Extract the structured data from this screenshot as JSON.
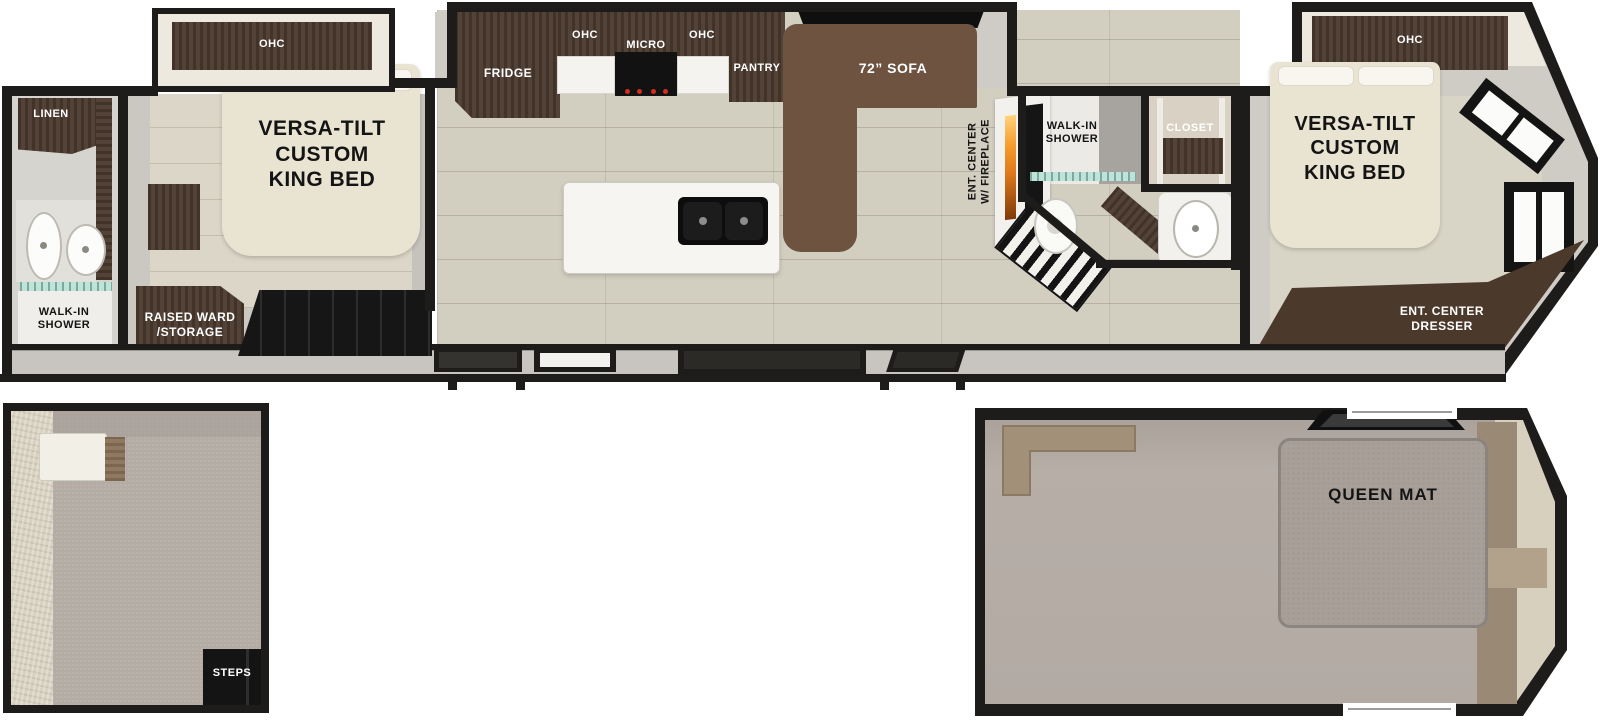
{
  "floorplan": {
    "bath_left": {
      "linen": "LINEN",
      "shower": "WALK-IN\nSHOWER"
    },
    "bedroom_left": {
      "ohc": "OHC",
      "bed": "VERSA-TILT\nCUSTOM\nKING BED",
      "storage": "RAISED WARD\n/STORAGE"
    },
    "kitchen": {
      "fridge": "FRIDGE",
      "ohc_left": "OHC",
      "micro": "MICRO",
      "ohc_right": "OHC",
      "pantry": "PANTRY"
    },
    "living": {
      "sofa": "72” SOFA",
      "ent_center": "ENT. CENTER\nW/ FIREPLACE"
    },
    "bath_right": {
      "shower": "WALK-IN\nSHOWER",
      "closet": "CLOSET"
    },
    "bedroom_right": {
      "ohc": "OHC",
      "bed": "VERSA-TILT\nCUSTOM\nKING BED",
      "dresser": "ENT. CENTER\nDRESSER"
    },
    "loft_left": {
      "steps": "STEPS"
    },
    "loft_right": {
      "queen_mat": "QUEEN MAT"
    }
  },
  "colors": {
    "wall": "#1d1c1a",
    "cabinet": "#4b3a2f",
    "sofa": "#6d5340",
    "bed": "#e9e4d2",
    "floor": "#d2cec0",
    "carpet": "#b4aca5",
    "mat": "#a89f99",
    "flame": "#e0791c",
    "glass": "#bfe3d9",
    "interior_wall": "#cfccc5"
  }
}
